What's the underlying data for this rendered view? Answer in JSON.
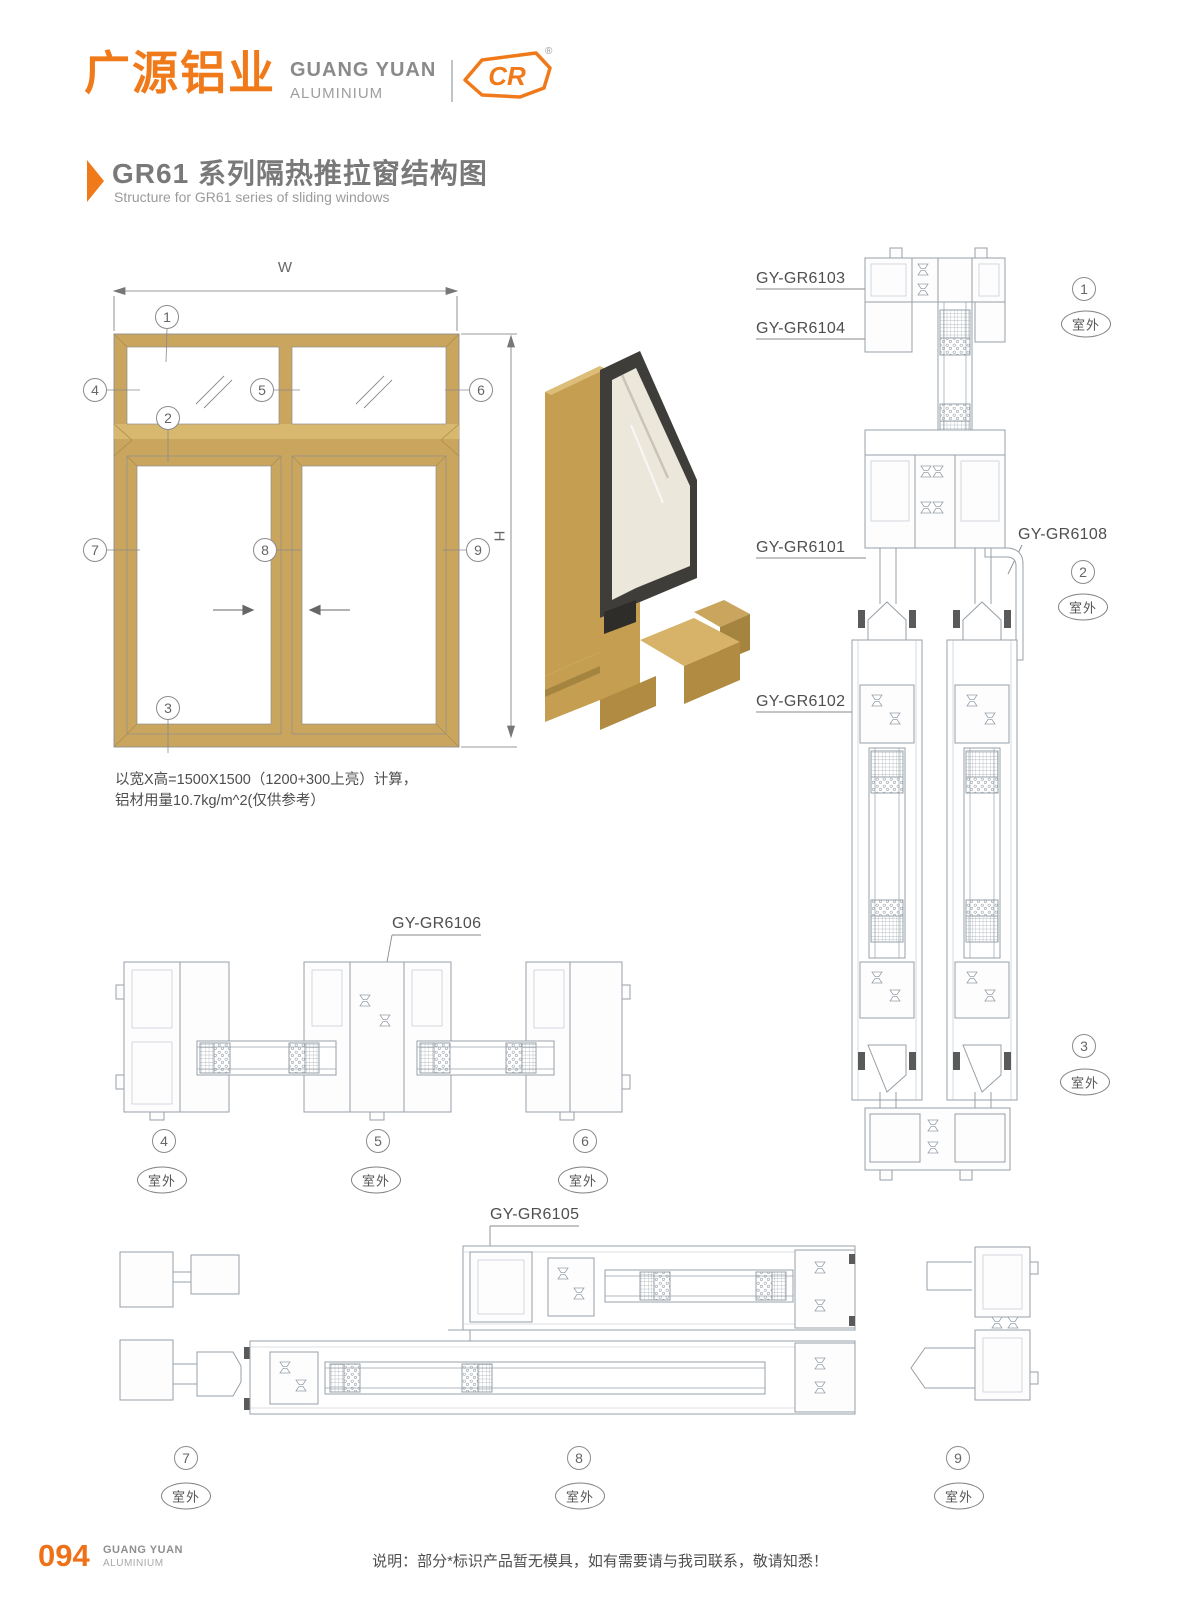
{
  "header": {
    "brand_cn": "广源铝业",
    "brand_en": "GUANG YUAN",
    "brand_en2": "ALUMINIUM",
    "logo_text": "CR",
    "registered_mark": "®"
  },
  "title": {
    "heading": "GR61 系列隔热推拉窗结构图",
    "subheading": "Structure for GR61 series of sliding windows"
  },
  "elevation": {
    "dim_width_label": "W",
    "dim_height_label": "H",
    "note_line1": "以宽X高=1500X1500（1200+300上亮）计算，",
    "note_line2": "铝材用量10.7kg/m^2(仅供参考）"
  },
  "callouts": {
    "c1": "1",
    "c2": "2",
    "c3": "3",
    "c4": "4",
    "c5": "5",
    "c6": "6",
    "c7": "7",
    "c8": "8",
    "c9": "9"
  },
  "labels": {
    "outdoor": "室外"
  },
  "profiles": {
    "gr6103": "GY-GR6103",
    "gr6104": "GY-GR6104",
    "gr6101": "GY-GR6101",
    "gr6108": "GY-GR6108",
    "gr6102": "GY-GR6102",
    "gr6106": "GY-GR6106",
    "gr6105": "GY-GR6105"
  },
  "footer": {
    "page_number": "094",
    "brand_en": "GUANG YUAN",
    "brand_en2": "ALUMINIUM",
    "note": "说明：部分*标识产品暂无模具，如有需要请与我司联系，敬请知悉！"
  },
  "colors": {
    "accent": "#F07A1A",
    "frame_gold": "#C9A55E",
    "drawing_line": "#97A0A8"
  }
}
